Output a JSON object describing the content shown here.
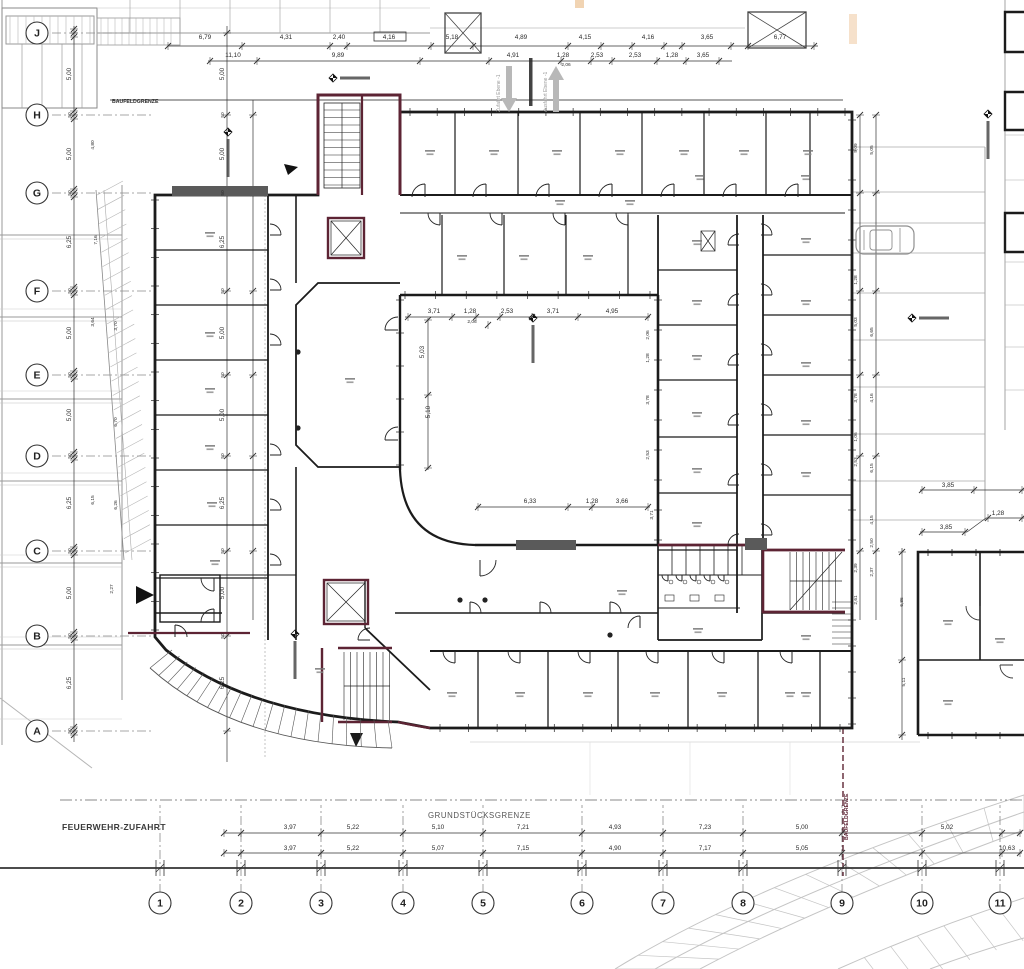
{
  "colors": {
    "wall": "#1b1b1b",
    "accent_maroon": "#5d2434",
    "site_gray": "#9a9a9a",
    "light_gray": "#c4c4c4",
    "dim_text": "#2b2b2b",
    "orange_mark": "#eec9a0"
  },
  "site_labels": {
    "feuerwehr": "FEUERWEHR-ZUFAHRT",
    "grundstuecksgrenze": "GRUNDSTÜCKSGRENZE",
    "baufeld_top": "BAUFELDGRENZE",
    "baufeld_right": "BAUFELDGRENZE",
    "ramp_in": "Zufahrt Ebene -1",
    "ramp_out": "Ausfahrt Ebene -1"
  },
  "grid": {
    "bubble_x": 37,
    "bubble_y": 903,
    "cols": [
      {
        "label": "1",
        "x": 160
      },
      {
        "label": "2",
        "x": 241
      },
      {
        "label": "3",
        "x": 321
      },
      {
        "label": "4",
        "x": 403
      },
      {
        "label": "5",
        "x": 483
      },
      {
        "label": "6",
        "x": 582
      },
      {
        "label": "7",
        "x": 663
      },
      {
        "label": "8",
        "x": 743
      },
      {
        "label": "9",
        "x": 842
      },
      {
        "label": "10",
        "x": 922
      },
      {
        "label": "11",
        "x": 1000
      }
    ],
    "rows": [
      {
        "label": "A",
        "y": 731
      },
      {
        "label": "B",
        "y": 636
      },
      {
        "label": "C",
        "y": 551
      },
      {
        "label": "D",
        "y": 456
      },
      {
        "label": "E",
        "y": 375
      },
      {
        "label": "F",
        "y": 291
      },
      {
        "label": "G",
        "y": 193
      },
      {
        "label": "H",
        "y": 115
      },
      {
        "label": "J",
        "y": 33
      }
    ]
  },
  "dimensions": {
    "top_row1_y": 39,
    "top_row1": [
      {
        "x": 205,
        "t": "6,79"
      },
      {
        "x": 286,
        "t": "4,31"
      },
      {
        "x": 339,
        "t": "2,40"
      },
      {
        "x": 389,
        "t": "4,16"
      },
      {
        "x": 452,
        "t": "5,18"
      },
      {
        "x": 521,
        "t": "4,89"
      },
      {
        "x": 585,
        "t": "4,15"
      },
      {
        "x": 648,
        "t": "4,16"
      },
      {
        "x": 707,
        "t": "3,65"
      },
      {
        "x": 780,
        "t": "6,77"
      }
    ],
    "top_row2_y": 57,
    "top_row2": [
      {
        "x": 233,
        "t": "11,10"
      },
      {
        "x": 338,
        "t": "9,89"
      },
      {
        "x": 513,
        "t": "4,91"
      },
      {
        "x": 563,
        "t": "1,28"
      },
      {
        "x": 597,
        "t": "2,53"
      },
      {
        "x": 635,
        "t": "2,53"
      },
      {
        "x": 672,
        "t": "1,28"
      },
      {
        "x": 703,
        "t": "3,65"
      }
    ],
    "top_sub": [
      {
        "x": 566,
        "y": 66,
        "t": "2,06"
      }
    ],
    "bottom_row1_y": 829,
    "bottom_row1": [
      {
        "x": 290,
        "t": "3,97"
      },
      {
        "x": 353,
        "t": "5,22"
      },
      {
        "x": 438,
        "t": "5,10"
      },
      {
        "x": 523,
        "t": "7,21"
      },
      {
        "x": 615,
        "t": "4,93"
      },
      {
        "x": 705,
        "t": "7,23"
      },
      {
        "x": 802,
        "t": "5,00"
      },
      {
        "x": 947,
        "t": "5,02"
      }
    ],
    "bottom_row2_y": 850,
    "bottom_row2": [
      {
        "x": 290,
        "t": "3,97"
      },
      {
        "x": 353,
        "t": "5,22"
      },
      {
        "x": 438,
        "t": "5,07"
      },
      {
        "x": 523,
        "t": "7,15"
      },
      {
        "x": 615,
        "t": "4,90"
      },
      {
        "x": 705,
        "t": "7,17"
      },
      {
        "x": 802,
        "t": "5,05"
      },
      {
        "x": 1007,
        "t": "10,63"
      }
    ],
    "courtyard_top_y": 313,
    "courtyard_top": [
      {
        "x": 434,
        "t": "3,71"
      },
      {
        "x": 470,
        "t": "1,28"
      },
      {
        "x": 507,
        "t": "2,53"
      },
      {
        "x": 553,
        "t": "3,71"
      },
      {
        "x": 612,
        "t": "4,95"
      }
    ],
    "courtyard_sub": [
      {
        "x": 472,
        "y": 323,
        "t": "2,06"
      }
    ],
    "courtyard_bottom_y": 503,
    "courtyard_bottom": [
      {
        "x": 530,
        "t": "6,33"
      },
      {
        "x": 592,
        "t": "1,28"
      },
      {
        "x": 622,
        "t": "3,66"
      }
    ],
    "courtyard_left": [
      {
        "x": 424,
        "y": 352,
        "t": "5,03"
      },
      {
        "x": 430,
        "y": 412,
        "t": "5,10"
      }
    ],
    "courtyard_right": [
      {
        "x": 649,
        "y": 335,
        "t": "2,06"
      },
      {
        "x": 649,
        "y": 358,
        "t": "1,28"
      },
      {
        "x": 649,
        "y": 400,
        "t": "3,78"
      },
      {
        "x": 649,
        "y": 455,
        "t": "2,53"
      },
      {
        "x": 653,
        "y": 515,
        "t": "3,71"
      }
    ],
    "left_chain_a_x": 74,
    "left_chain_a": [
      {
        "y": 74,
        "t": "5,00"
      },
      {
        "y": 115,
        "t": "50"
      },
      {
        "y": 154,
        "t": "5,00"
      },
      {
        "y": 193,
        "t": "50"
      },
      {
        "y": 242,
        "t": "6,25"
      },
      {
        "y": 291,
        "t": "50"
      },
      {
        "y": 333,
        "t": "5,00"
      },
      {
        "y": 375,
        "t": "50"
      },
      {
        "y": 415,
        "t": "5,00"
      },
      {
        "y": 456,
        "t": "50"
      },
      {
        "y": 503,
        "t": "6,25"
      },
      {
        "y": 551,
        "t": "50"
      },
      {
        "y": 593,
        "t": "5,00"
      },
      {
        "y": 636,
        "t": "50"
      },
      {
        "y": 683,
        "t": "6,25"
      },
      {
        "y": 731,
        "t": "50"
      }
    ],
    "left_chain_b_x": 227,
    "left_chain_b": [
      {
        "y": 74,
        "t": "5,00"
      },
      {
        "y": 115,
        "t": "50"
      },
      {
        "y": 154,
        "t": "5,00"
      },
      {
        "y": 193,
        "t": "50"
      },
      {
        "y": 242,
        "t": "6,25"
      },
      {
        "y": 291,
        "t": "50"
      },
      {
        "y": 333,
        "t": "5,00"
      },
      {
        "y": 375,
        "t": "50"
      },
      {
        "y": 415,
        "t": "5,00"
      },
      {
        "y": 456,
        "t": "50"
      },
      {
        "y": 503,
        "t": "6,25"
      },
      {
        "y": 551,
        "t": "50"
      },
      {
        "y": 593,
        "t": "5,00"
      },
      {
        "y": 636,
        "t": "50"
      },
      {
        "y": 683,
        "t": "6,25"
      }
    ],
    "left_diag": [
      {
        "x": 94,
        "y": 145,
        "t": "4,80"
      },
      {
        "x": 97,
        "y": 240,
        "t": "7,16"
      },
      {
        "x": 94,
        "y": 322,
        "t": "3,64"
      },
      {
        "x": 117,
        "y": 326,
        "t": "3,70"
      },
      {
        "x": 117,
        "y": 422,
        "t": "6,70"
      },
      {
        "x": 94,
        "y": 500,
        "t": "6,15"
      },
      {
        "x": 117,
        "y": 505,
        "t": "6,26"
      },
      {
        "x": 113,
        "y": 589,
        "t": "2,27"
      }
    ],
    "right_chain_a_x": 860,
    "right_chain_a": [
      {
        "y": 148,
        "t": "5,09"
      },
      {
        "y": 280,
        "t": "1,28"
      },
      {
        "y": 322,
        "t": "5,03"
      },
      {
        "y": 398,
        "t": "3,78"
      },
      {
        "y": 437,
        "t": "1,06"
      },
      {
        "y": 462,
        "t": "2,53"
      },
      {
        "y": 568,
        "t": "2,39"
      },
      {
        "y": 600,
        "t": "2,61"
      }
    ],
    "right_chain_b_x": 876,
    "right_chain_b": [
      {
        "y": 150,
        "t": "5,05"
      },
      {
        "y": 332,
        "t": "6,65"
      },
      {
        "y": 398,
        "t": "4,16"
      },
      {
        "y": 468,
        "t": "6,15"
      },
      {
        "y": 520,
        "t": "4,15"
      },
      {
        "y": 543,
        "t": "2,50"
      },
      {
        "y": 572,
        "t": "2,37"
      }
    ],
    "right_building_h": [
      {
        "x": 948,
        "y": 487,
        "t": "3,85"
      },
      {
        "x": 946,
        "y": 529,
        "t": "3,85"
      },
      {
        "x": 998,
        "y": 515,
        "t": "1,28"
      }
    ],
    "right_building_v": [
      {
        "x": 903,
        "y": 602,
        "t": "6,86"
      },
      {
        "x": 905,
        "y": 682,
        "t": "5,11"
      }
    ]
  },
  "icons": {
    "level_markers": [
      {
        "x": 228,
        "y": 132,
        "bar": "v"
      },
      {
        "x": 333,
        "y": 78,
        "bar": "h"
      },
      {
        "x": 533,
        "y": 318,
        "bar": "v"
      },
      {
        "x": 295,
        "y": 634,
        "bar": "v"
      },
      {
        "x": 988,
        "y": 114,
        "bar": "v"
      },
      {
        "x": 912,
        "y": 318,
        "bar": "h"
      }
    ],
    "entrance_arrow": {
      "x": 136,
      "y": 595
    },
    "plan_triangle": {
      "x": 290,
      "y": 168
    },
    "ramp_arrow_down": {
      "x": 509,
      "y": 66
    },
    "ramp_arrow_up": {
      "x": 556,
      "y": 66
    },
    "car": {
      "x": 856,
      "y": 226
    }
  }
}
